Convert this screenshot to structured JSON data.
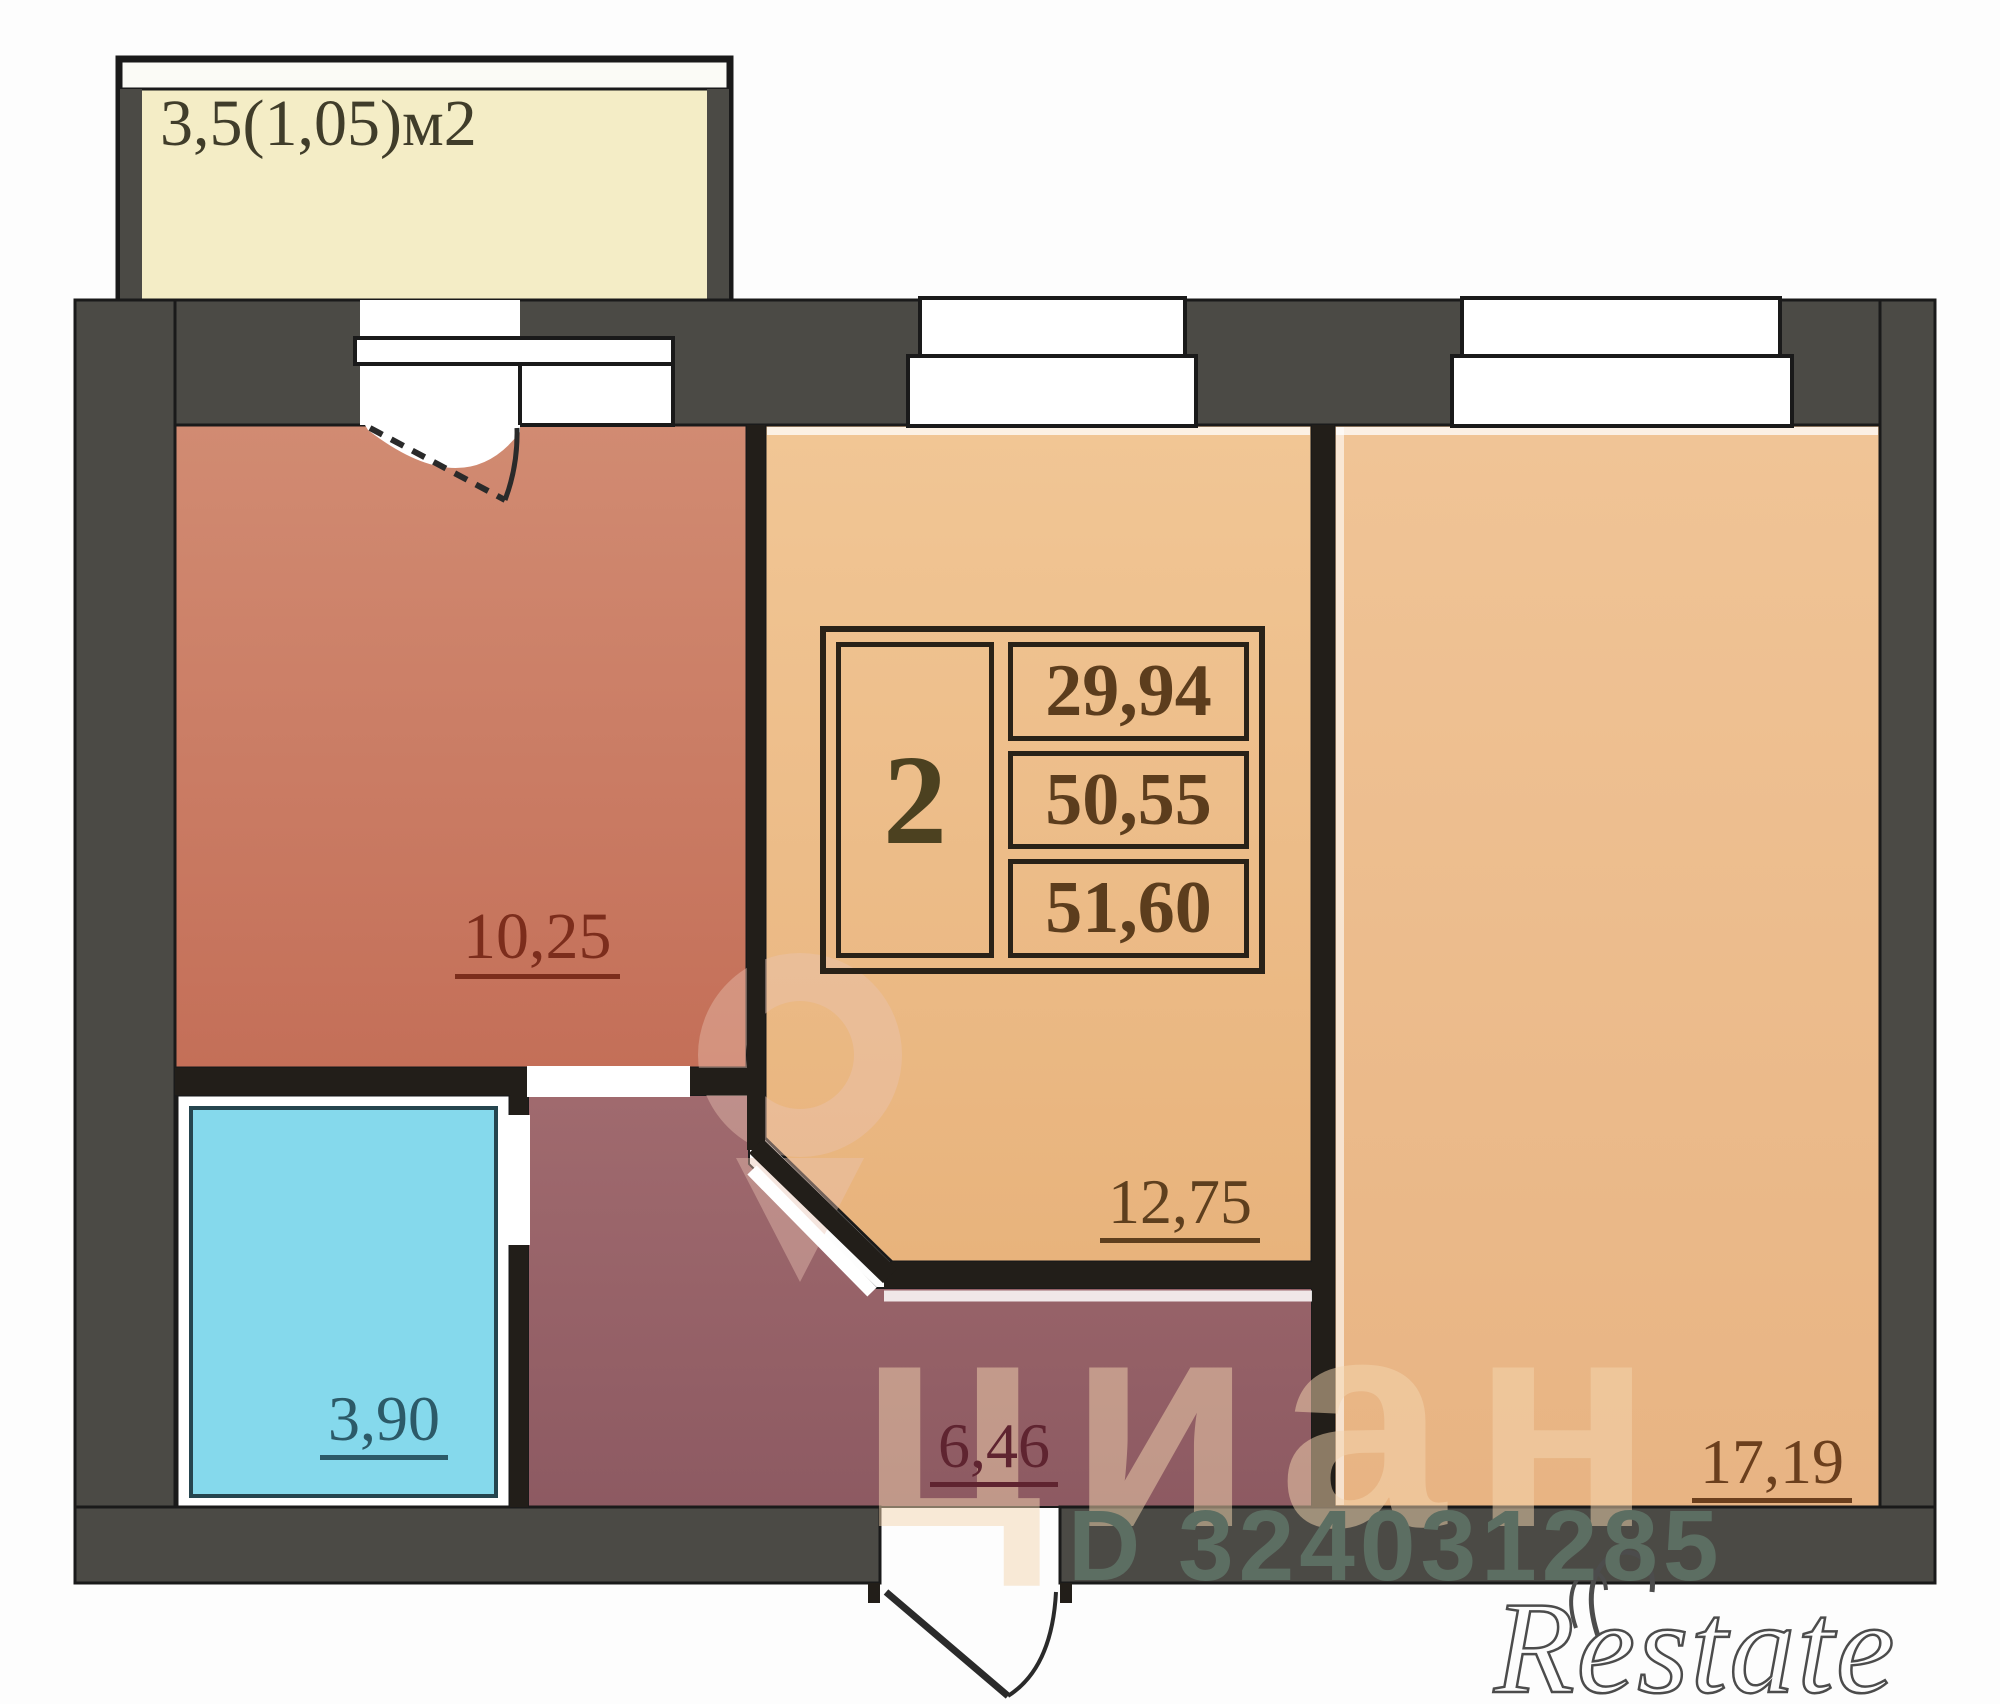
{
  "plan": {
    "type": "apartment-floor-plan",
    "balcony": {
      "label": "3,5(1,05)м2"
    },
    "rooms": {
      "bedroom": {
        "area": "10,25"
      },
      "bathroom": {
        "area": "3,90"
      },
      "hallway": {
        "area": "6,46"
      },
      "kitchen": {
        "area": "12,75"
      },
      "living_room": {
        "area": "17,19"
      }
    },
    "info_table": {
      "rooms_count": "2",
      "living_area": "29,94",
      "area": "50,55",
      "total_area": "51,60"
    }
  },
  "watermarks": {
    "brand": "циан",
    "listing_id": "D 324031285",
    "logo": "Restate"
  },
  "colors": {
    "wall": "#4b4a45",
    "wall_outline": "#1a1a1a",
    "balcony_fill": "#f4edc6",
    "bedroom_fill": "#c97f67",
    "bathroom_fill": "#85d9ec",
    "hallway_fill": "#97646a",
    "kitchen_fill": "#eec08d",
    "living_fill": "#ecbf90",
    "label_red": "#7c2d1c",
    "label_blue": "#2c5a68",
    "label_brown": "#5e3f1e"
  }
}
